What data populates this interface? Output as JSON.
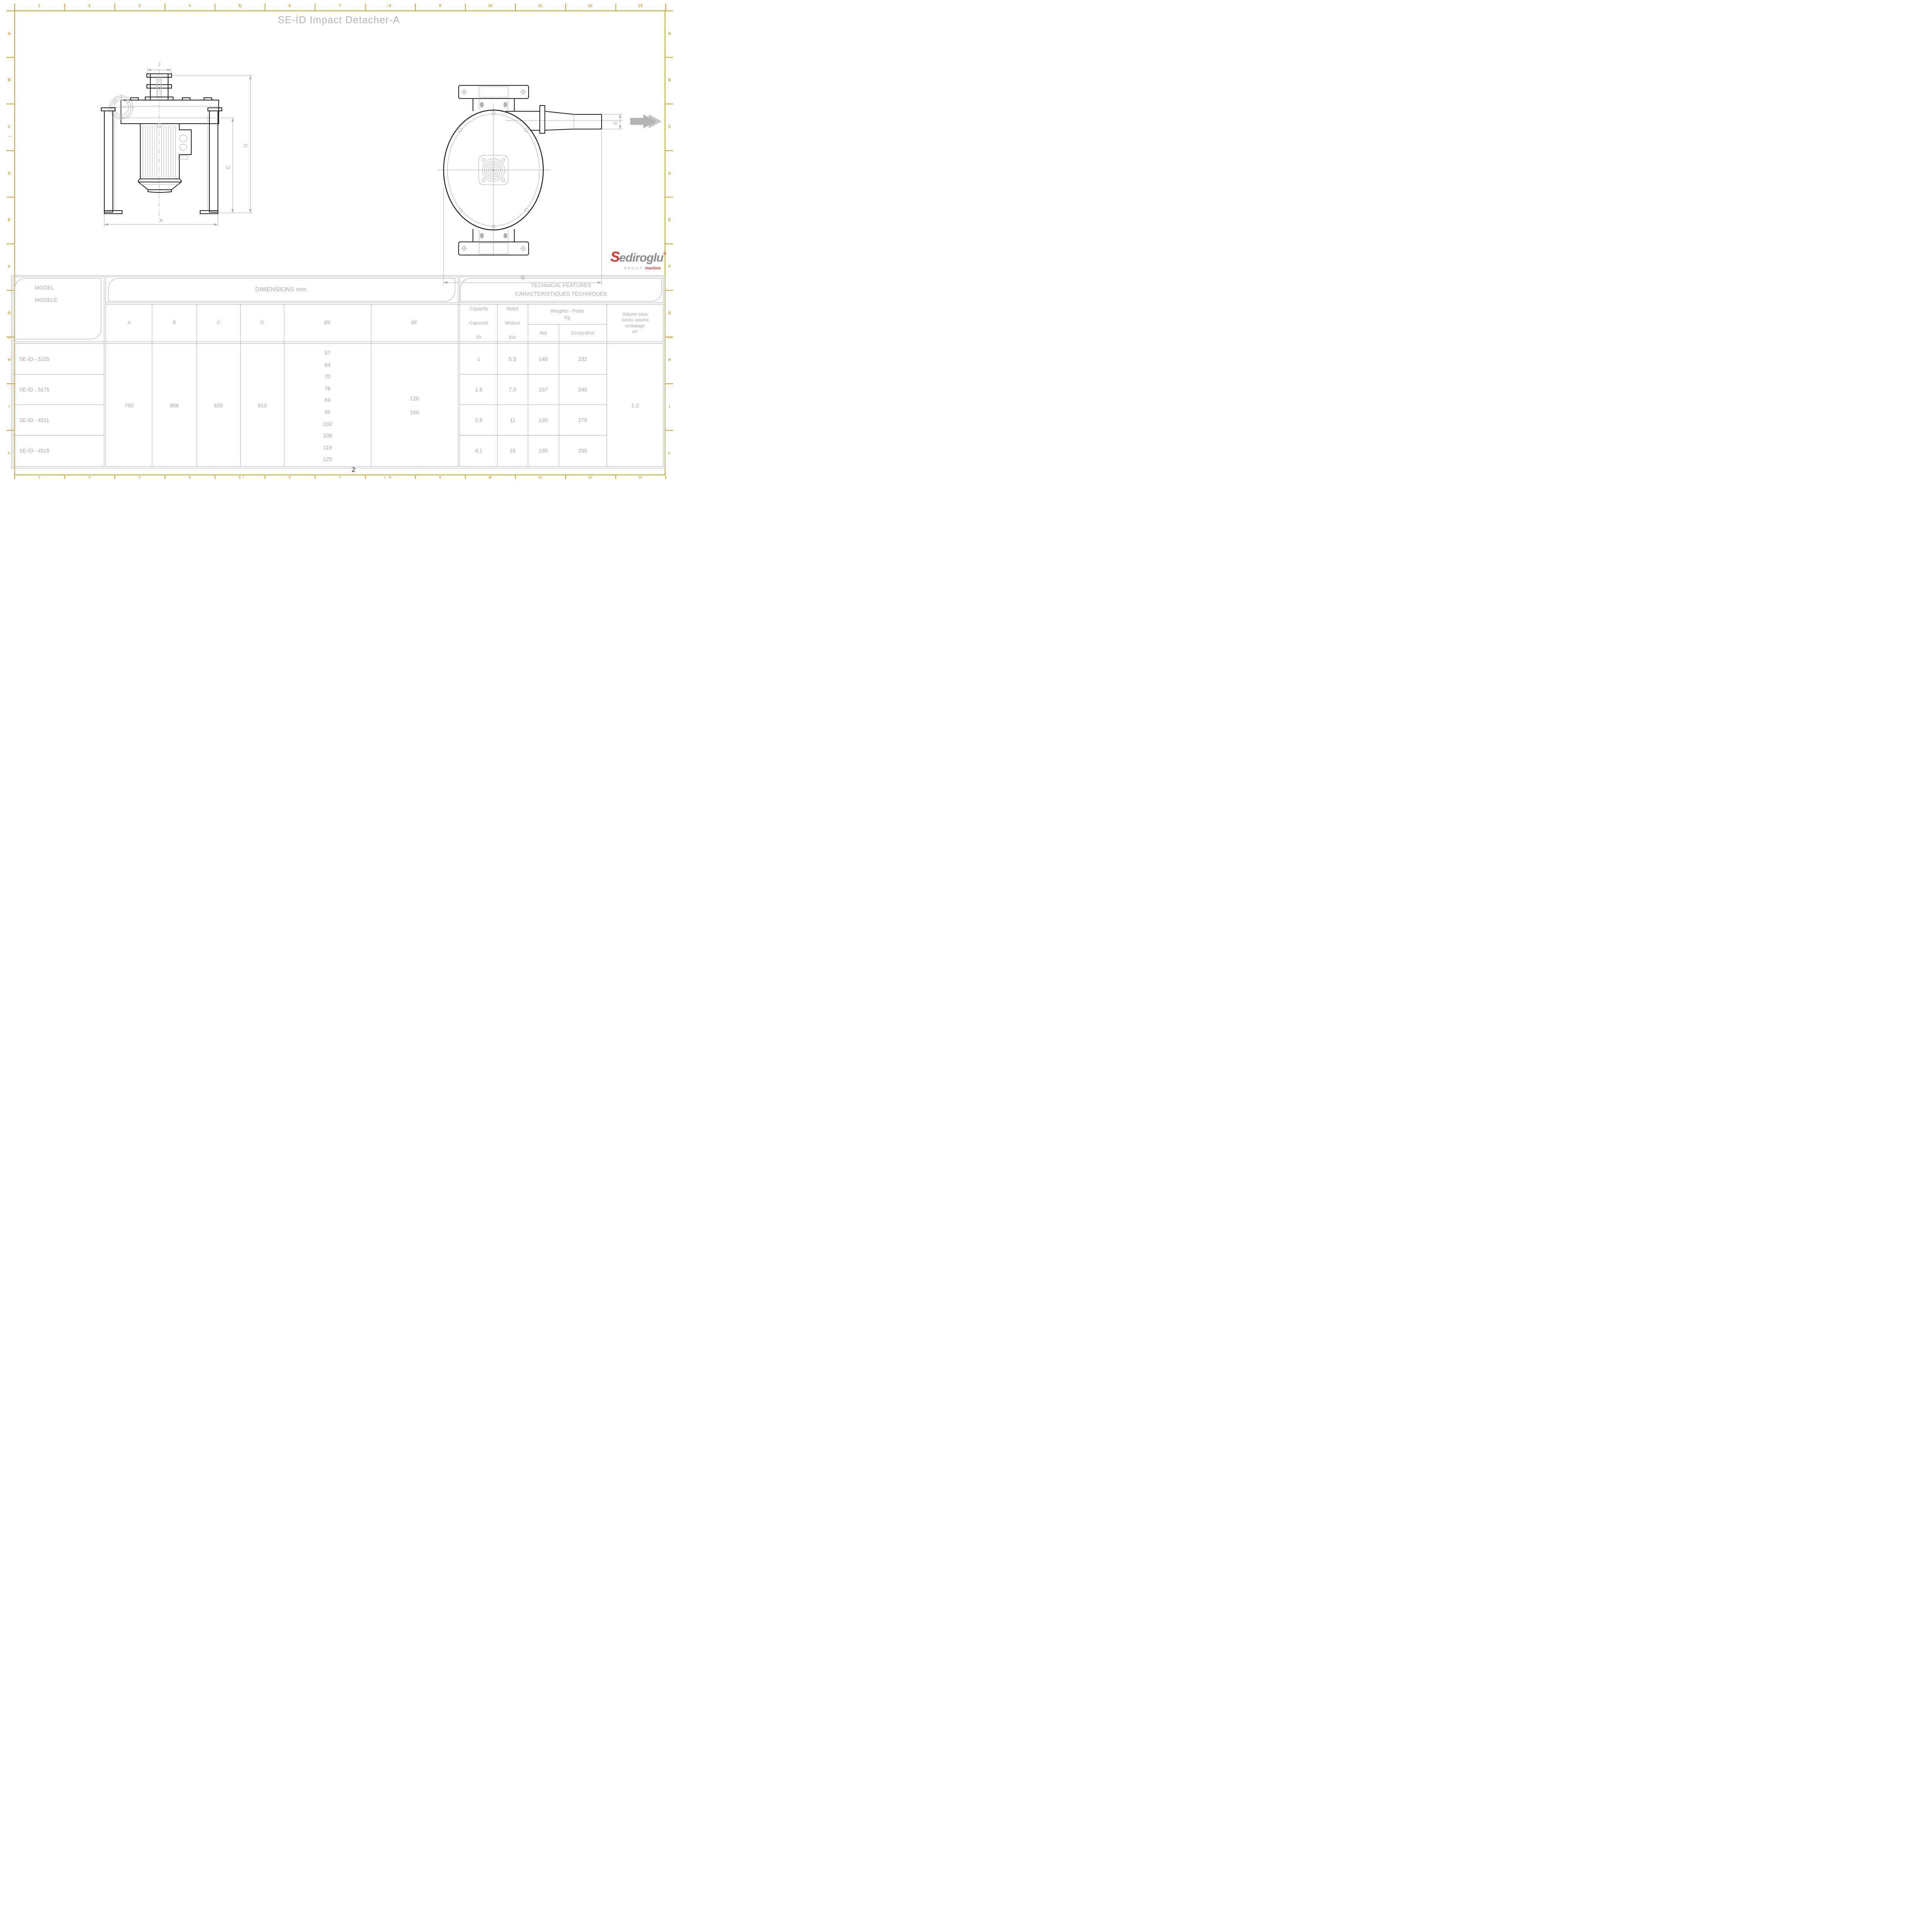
{
  "title": "SE-İD Impact Detacher-A",
  "page_number": "2",
  "frame": {
    "gold_color": "#D2A11E",
    "columns": [
      "1",
      "2",
      "3",
      "4",
      "5",
      "6",
      "7",
      "8",
      "9",
      "10",
      "11",
      "12",
      "13"
    ],
    "rows": [
      "A",
      "B",
      "C",
      "D",
      "E",
      "F",
      "G",
      "H",
      "I",
      "L"
    ],
    "marks": {
      "top_down": "↓",
      "top_up": "↑",
      "bottom_up": "↑",
      "bottom_down": "↓",
      "left_right": "→",
      "left_left": "←",
      "right_right": "→"
    }
  },
  "logo": {
    "s": "S",
    "name_rest": "ediroglu",
    "registered": "®",
    "group": "GROUP",
    "machine": "machine",
    "red": "#E2342B",
    "gray": "#8d8d8d"
  },
  "drawing": {
    "labels": {
      "J": "J",
      "A": "A",
      "C": "C",
      "D": "D",
      "B": "B",
      "E": "E"
    }
  },
  "table": {
    "model_header_line1": "MODEL",
    "model_header_line2": "MODELE",
    "dimensions_header": "DIMENSIONS mm.",
    "technical_header_line1": "TECHNICAL FEATURES",
    "technical_header_line2": "CARACTERISTIQUES TECHNIQUES",
    "dim_columns": {
      "a": "A",
      "b": "B",
      "c": "C",
      "d": "D",
      "oe": "ØE",
      "of": "ØF"
    },
    "capacity_l1": "Capacity",
    "capacity_l2": "Capacité",
    "capacity_l3": "t/h",
    "motor_l1": "Motor",
    "motor_l2": "Moteur",
    "motor_l3": "Kw",
    "weights_l1": "Weights - Poids",
    "weights_l2": "Kg",
    "net_label": "Net",
    "gross_label": "Gross-Brut",
    "volume_l1": "Volume sous",
    "volume_l2": "Gross volume",
    "volume_l3": "embalage",
    "volume_l4": "m³",
    "models": [
      "SE-İD - 5155",
      "SE-İD - 5175",
      "SE-İD - 4511",
      "SE-İD - 4515"
    ],
    "dim_values": {
      "a": "700",
      "b": "806",
      "c": "620",
      "d": "913"
    },
    "oe_values": [
      "57",
      "64",
      "70",
      "76",
      "83",
      "95",
      "102",
      "108",
      "119",
      "125"
    ],
    "of_values": [
      "120",
      "150"
    ],
    "capacity_values": [
      "1",
      "1.6",
      "2.8",
      "4,1"
    ],
    "motor_values": [
      "5.5",
      "7.5",
      "11",
      "15"
    ],
    "net_values": [
      "148",
      "157",
      "190",
      "195"
    ],
    "gross_values": [
      "232",
      "240",
      "275",
      "290"
    ],
    "volume_value": "1.2"
  }
}
